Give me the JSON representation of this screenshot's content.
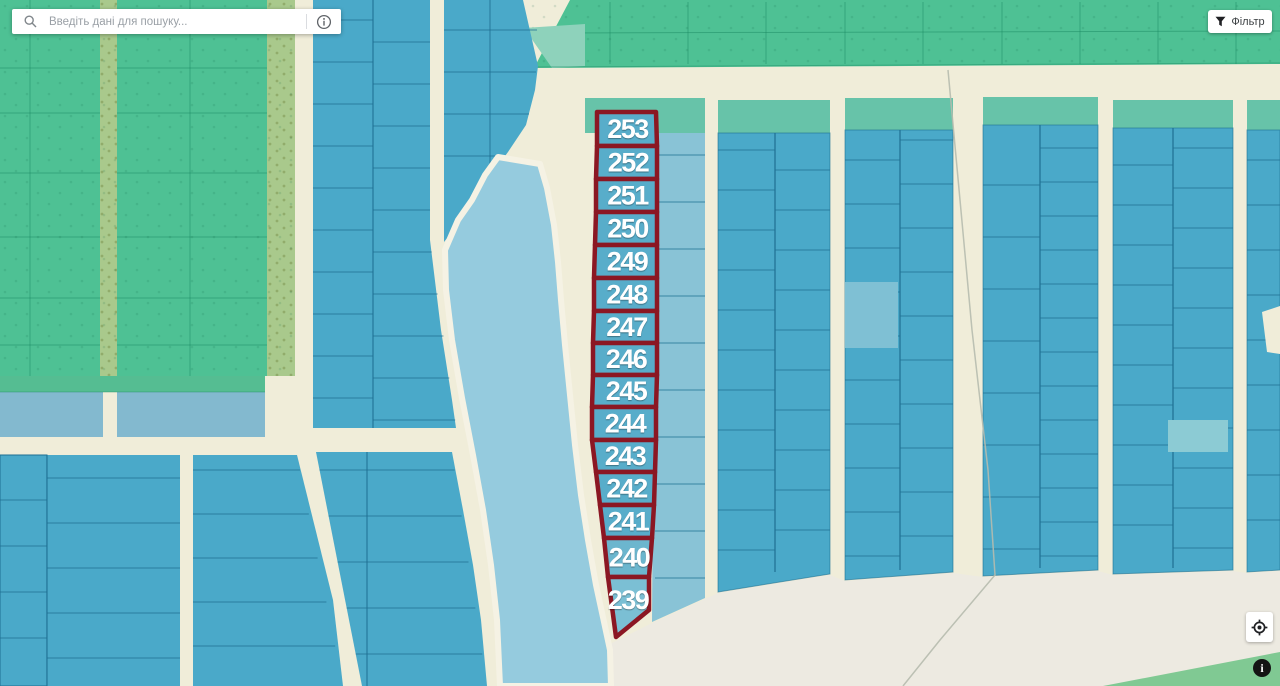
{
  "search": {
    "placeholder": "Введіть дані для пошуку...",
    "magnifier_icon": "search-icon",
    "info_icon": "info-circle-icon"
  },
  "filter": {
    "label": "Фільтр",
    "icon": "filter-funnel-icon"
  },
  "map": {
    "controls": {
      "locate_icon": "crosshair-target-icon",
      "attribution_icon": "info-icon",
      "attribution_glyph": "i"
    },
    "highlighted_parcels": {
      "numbers": [
        "253",
        "252",
        "251",
        "250",
        "249",
        "248",
        "247",
        "246",
        "245",
        "244",
        "243",
        "242",
        "241",
        "240",
        "239"
      ],
      "outline_color": "#8b1723",
      "label_color": "#ffffff"
    },
    "colors": {
      "field_green": "#4ec194",
      "field_green_strip": "#55bd92",
      "tree_strip_olive": "#a9c98c",
      "parcel_blue": "#4aa9c9",
      "parcel_blue_light": "#89c3d6",
      "parcel_blue_pale": "#7fc0d4",
      "parcel_teal_pale": "#8ccbd4",
      "band_blue_grey": "#83b9cf",
      "water_light_blue": "#95cbde",
      "teal_band": "#67c3a9",
      "teal_wedge": "#8ed2bb",
      "road_cream": "#f0edd9",
      "open_ground": "#edeae1",
      "green_wedge": "#80c993",
      "highlight_red": "#8b1723"
    }
  }
}
